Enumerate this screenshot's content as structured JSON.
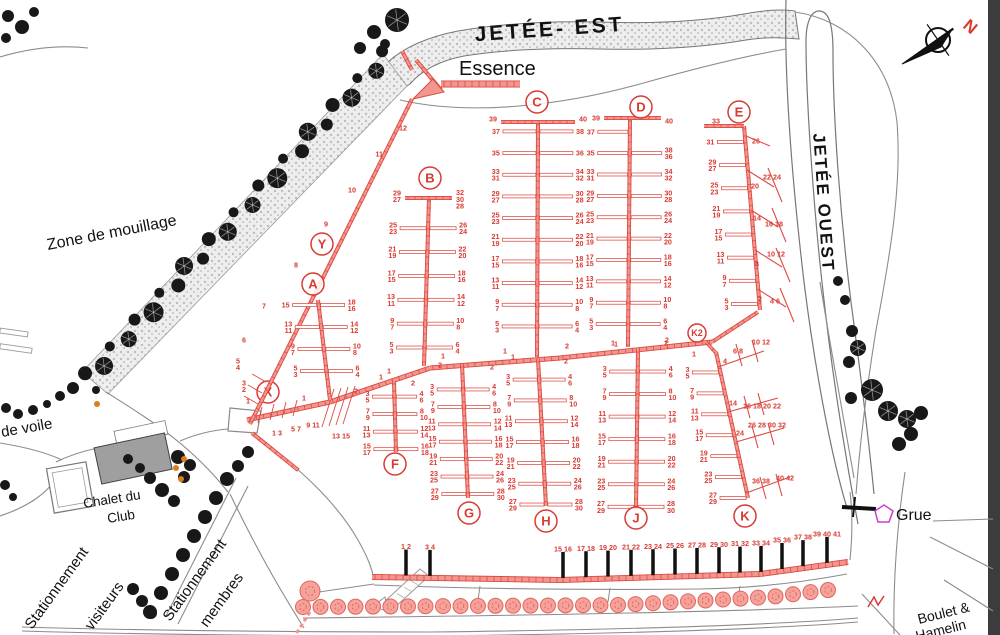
{
  "labels": {
    "jetee_est": "JETÉE- EST",
    "jetee_ouest": "JETÉE OUEST",
    "essence": "Essence",
    "zone_mouillage": "Zone de mouillage",
    "de_voile": "de voile",
    "chalet_line1": "Chalet du",
    "chalet_line2": "Club",
    "visiteurs_line1": "Stationnement",
    "visiteurs_line2": "visiteurs",
    "membres_line1": "Stationnement",
    "membres_line2": "membres",
    "grue": "Grue",
    "street_line1": "Boulet &",
    "street_line2": "Hamelin",
    "north": "N"
  },
  "colors": {
    "dock_red": "#dd4a42",
    "dock_fill": "#f2978f",
    "number_red": "#d93a32",
    "tree_black": "#181818",
    "tree_pink": "#f5a29b",
    "magenta": "#cc3fcc",
    "orange": "#e07b1f",
    "shore_gray": "#8c8c8c"
  },
  "docks": {
    "A": {
      "letter": "A",
      "levels": [
        {
          "l": [
            "15"
          ],
          "r": [
            "18",
            "16"
          ]
        },
        {
          "l": [
            "13",
            "11"
          ],
          "r": [
            "14",
            "12"
          ]
        },
        {
          "l": [
            "9",
            "7"
          ],
          "r": [
            "10",
            "8"
          ]
        },
        {
          "l": [
            "5",
            "3"
          ],
          "r": [
            "6",
            "4"
          ]
        }
      ],
      "jl": "1",
      "jr": "2"
    },
    "B": {
      "letter": "B",
      "top_left": [
        "29",
        "27"
      ],
      "top_right": [
        "32",
        "30",
        "28"
      ],
      "levels": [
        {
          "l": [
            "25",
            "23"
          ],
          "r": [
            "26",
            "24"
          ]
        },
        {
          "l": [
            "21",
            "19"
          ],
          "r": [
            "22",
            "20"
          ]
        },
        {
          "l": [
            "17",
            "15"
          ],
          "r": [
            "18",
            "16"
          ]
        },
        {
          "l": [
            "13",
            "11"
          ],
          "r": [
            "14",
            "12"
          ]
        },
        {
          "l": [
            "9",
            "7"
          ],
          "r": [
            "10",
            "8"
          ]
        },
        {
          "l": [
            "5",
            "3"
          ],
          "r": [
            "6",
            "4"
          ]
        }
      ],
      "jl": "1",
      "jr": "2"
    },
    "C": {
      "letter": "C",
      "top_left": [
        "39"
      ],
      "top_right": [
        "40"
      ],
      "levels": [
        {
          "l": [
            "37"
          ],
          "r": [
            "38"
          ]
        },
        {
          "l": [
            "35"
          ],
          "r": [
            "36"
          ]
        },
        {
          "l": [
            "33",
            "31"
          ],
          "r": [
            "34",
            "32"
          ]
        },
        {
          "l": [
            "29",
            "27"
          ],
          "r": [
            "30",
            "28"
          ]
        },
        {
          "l": [
            "25",
            "23"
          ],
          "r": [
            "26",
            "24"
          ]
        },
        {
          "l": [
            "21",
            "19"
          ],
          "r": [
            "22",
            "20"
          ]
        },
        {
          "l": [
            "17",
            "15"
          ],
          "r": [
            "18",
            "16"
          ]
        },
        {
          "l": [
            "13",
            "11"
          ],
          "r": [
            "14",
            "12"
          ]
        },
        {
          "l": [
            "9",
            "7"
          ],
          "r": [
            "10",
            "8"
          ]
        },
        {
          "l": [
            "5",
            "3"
          ],
          "r": [
            "6",
            "4"
          ]
        }
      ],
      "jl": "1",
      "jr": "2"
    },
    "D": {
      "letter": "D",
      "top_left": [
        "39"
      ],
      "top_right": [
        "40"
      ],
      "levels": [
        {
          "l": [
            "37"
          ],
          "r": []
        },
        {
          "l": [
            "35"
          ],
          "r": [
            "38",
            "36"
          ]
        },
        {
          "l": [
            "33",
            "31"
          ],
          "r": [
            "34",
            "32"
          ]
        },
        {
          "l": [
            "29",
            "27"
          ],
          "r": [
            "30",
            "28"
          ]
        },
        {
          "l": [
            "25",
            "23"
          ],
          "r": [
            "26",
            "24"
          ]
        },
        {
          "l": [
            "21",
            "19"
          ],
          "r": [
            "22",
            "20"
          ]
        },
        {
          "l": [
            "17",
            "15"
          ],
          "r": [
            "18",
            "16"
          ]
        },
        {
          "l": [
            "13",
            "11"
          ],
          "r": [
            "14",
            "12"
          ]
        },
        {
          "l": [
            "9",
            "7"
          ],
          "r": [
            "10",
            "8"
          ]
        },
        {
          "l": [
            "5",
            "3"
          ],
          "r": [
            "6",
            "4"
          ]
        }
      ],
      "jl": "1",
      "jr": "2"
    },
    "E": {
      "letter": "E",
      "top_left": [
        "33"
      ],
      "levels": [
        {
          "l": [
            "31"
          ],
          "r": []
        },
        {
          "l": [
            "29",
            "27"
          ],
          "r": []
        },
        {
          "l": [
            "25",
            "23"
          ],
          "r": []
        },
        {
          "l": [
            "21",
            "19"
          ],
          "r": []
        },
        {
          "l": [
            "17",
            "15"
          ],
          "r": []
        },
        {
          "l": [
            "13",
            "11"
          ],
          "r": []
        },
        {
          "l": [
            "9",
            "7"
          ],
          "r": []
        },
        {
          "l": [
            "5",
            "3"
          ],
          "r": []
        }
      ],
      "right_groups": [
        "26",
        "20",
        "22 24",
        "14",
        "16 18",
        "8",
        "10 12",
        "2",
        "4 6"
      ]
    },
    "F": {
      "letter": "F",
      "levels": [
        {
          "l": [
            "3",
            "5"
          ],
          "r": [
            "4",
            "6"
          ]
        },
        {
          "l": [
            "7",
            "9"
          ],
          "r": [
            "8",
            "10"
          ]
        },
        {
          "l": [
            "11",
            "13"
          ],
          "r": [
            "12",
            "14"
          ]
        },
        {
          "l": [
            "15",
            "17"
          ],
          "r": [
            "16",
            "18"
          ]
        }
      ],
      "jl": "1",
      "jr": "2"
    },
    "G": {
      "letter": "G",
      "levels": [
        {
          "l": [
            "3",
            "5"
          ],
          "r": [
            "4",
            "6"
          ]
        },
        {
          "l": [
            "7",
            "9"
          ],
          "r": [
            "8",
            "10"
          ]
        },
        {
          "l": [
            "11",
            "13"
          ],
          "r": [
            "12",
            "14"
          ]
        },
        {
          "l": [
            "15",
            "17"
          ],
          "r": [
            "16",
            "18"
          ]
        },
        {
          "l": [
            "19",
            "21"
          ],
          "r": [
            "20",
            "22"
          ]
        },
        {
          "l": [
            "23",
            "25"
          ],
          "r": [
            "24",
            "26"
          ]
        },
        {
          "l": [
            "27",
            "29"
          ],
          "r": [
            "28",
            "30"
          ]
        }
      ],
      "jl": "1",
      "jr": "2"
    },
    "H": {
      "letter": "H",
      "levels": [
        {
          "l": [
            "3",
            "5"
          ],
          "r": [
            "4",
            "6"
          ]
        },
        {
          "l": [
            "7",
            "9"
          ],
          "r": [
            "8",
            "10"
          ]
        },
        {
          "l": [
            "11",
            "13"
          ],
          "r": [
            "12",
            "14"
          ]
        },
        {
          "l": [
            "15",
            "17"
          ],
          "r": [
            "16",
            "18"
          ]
        },
        {
          "l": [
            "19",
            "21"
          ],
          "r": [
            "20",
            "22"
          ]
        },
        {
          "l": [
            "23",
            "25"
          ],
          "r": [
            "24",
            "26"
          ]
        },
        {
          "l": [
            "27",
            "29"
          ],
          "r": [
            "28",
            "30"
          ]
        }
      ],
      "jl": "1",
      "jr": "2"
    },
    "J": {
      "letter": "J",
      "levels": [
        {
          "l": [
            "3",
            "5"
          ],
          "r": [
            "4",
            "6"
          ]
        },
        {
          "l": [
            "7",
            "9"
          ],
          "r": [
            "8",
            "10"
          ]
        },
        {
          "l": [
            "11",
            "13"
          ],
          "r": [
            "12",
            "14"
          ]
        },
        {
          "l": [
            "15",
            "17"
          ],
          "r": [
            "16",
            "18"
          ]
        },
        {
          "l": [
            "19",
            "21"
          ],
          "r": [
            "20",
            "22"
          ]
        },
        {
          "l": [
            "23",
            "25"
          ],
          "r": [
            "24",
            "26"
          ]
        },
        {
          "l": [
            "27",
            "29"
          ],
          "r": [
            "28",
            "30"
          ]
        }
      ],
      "jl": "1",
      "jr": "2"
    },
    "K": {
      "letter": "K",
      "levels": [
        {
          "l": [
            "3",
            "5"
          ],
          "r": []
        },
        {
          "l": [
            "7",
            "9"
          ],
          "r": []
        },
        {
          "l": [
            "11",
            "13"
          ],
          "r": []
        },
        {
          "l": [
            "15",
            "17"
          ],
          "r": []
        },
        {
          "l": [
            "19",
            "21"
          ],
          "r": []
        },
        {
          "l": [
            "23",
            "25"
          ],
          "r": []
        },
        {
          "l": [
            "27",
            "29"
          ],
          "r": []
        }
      ],
      "right_groups": [
        "4",
        "6 8",
        "10 12",
        "14",
        "16 18 20 22",
        "24",
        "26 28 30 32",
        "36 38",
        "40 42"
      ],
      "jl": "1"
    },
    "K2": {
      "letter": "K2"
    },
    "X": {
      "letter": "X",
      "slip_labels": [
        "1 3",
        "5 7",
        "9 11",
        "13 15"
      ]
    },
    "Y": {
      "letter": "Y",
      "along_labels": [
        "7",
        "8",
        "9",
        "10",
        "11",
        "12"
      ],
      "base_labels": [
        [
          "6"
        ],
        [
          "5",
          "4"
        ],
        [
          "3",
          "2"
        ],
        [
          "1"
        ]
      ]
    }
  },
  "bottom_dock": {
    "berth_pairs": [
      "1 2",
      "3 4",
      "15 16",
      "17 18",
      "19 20",
      "21 22",
      "23 24",
      "25 26",
      "27 28",
      "29 30",
      "31 32",
      "33 34",
      "35 36",
      "37 38",
      "39 40 41"
    ]
  }
}
